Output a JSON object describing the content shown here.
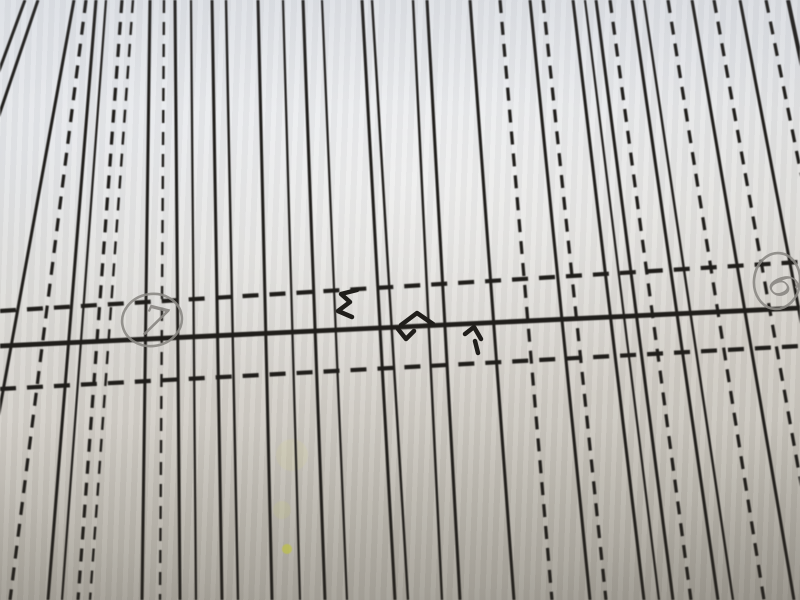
{
  "pattern": {
    "ink_color": "#201e1b",
    "pencil_color": "#8b8884",
    "vertical_dash": "13 9",
    "horizontal_dash": "16 11",
    "vertical_lines": [
      [
        25,
        -195,
        "s",
        3.0
      ],
      [
        38,
        -165,
        "s",
        3.0
      ],
      [
        74,
        -35,
        "s",
        3.0
      ],
      [
        86,
        10,
        "d",
        3.2
      ],
      [
        96,
        48,
        "s",
        3.0
      ],
      [
        106,
        62,
        "s",
        2.2
      ],
      [
        122,
        78,
        "d",
        3.2
      ],
      [
        133,
        90,
        "d",
        2.4
      ],
      [
        150,
        142,
        "s",
        3.0
      ],
      [
        164,
        160,
        "d",
        2.4
      ],
      [
        175,
        180,
        "s",
        3.0
      ],
      [
        191,
        196,
        "s",
        2.2
      ],
      [
        212,
        222,
        "s",
        3.0
      ],
      [
        226,
        238,
        "s",
        2.4
      ],
      [
        258,
        272,
        "s",
        3.0
      ],
      [
        283,
        300,
        "s",
        2.2
      ],
      [
        303,
        325,
        "s",
        3.0
      ],
      [
        322,
        347,
        "s",
        2.2
      ],
      [
        362,
        395,
        "s",
        3.0
      ],
      [
        372,
        408,
        "s",
        2.4
      ],
      [
        413,
        442,
        "s",
        2.4
      ],
      [
        427,
        460,
        "s",
        3.0
      ],
      [
        470,
        514,
        "s",
        3.0
      ],
      [
        500,
        552,
        "d",
        3.2
      ],
      [
        530,
        590,
        "s",
        3.0
      ],
      [
        543,
        606,
        "d",
        3.2
      ],
      [
        573,
        644,
        "s",
        3.0
      ],
      [
        585,
        659,
        "s",
        2.2
      ],
      [
        596,
        673,
        "s",
        3.0
      ],
      [
        610,
        691,
        "d",
        3.2
      ],
      [
        632,
        718,
        "s",
        3.0
      ],
      [
        644,
        733,
        "s",
        2.4
      ],
      [
        668,
        764,
        "d",
        3.2
      ],
      [
        692,
        794,
        "s",
        3.0
      ],
      [
        714,
        822,
        "d",
        3.2
      ],
      [
        740,
        854,
        "s",
        3.0
      ],
      [
        766,
        887,
        "d",
        3.2
      ],
      [
        788,
        915,
        "s",
        4.0
      ]
    ],
    "horizontal_lines": [
      [
        0,
        311,
        800,
        262,
        "d",
        4.2
      ],
      [
        0,
        346,
        800,
        308,
        "s",
        4.8
      ],
      [
        0,
        389,
        800,
        346,
        "d",
        4.2
      ]
    ],
    "notch_marks": [
      "357,290 341,294 350,302 338,311 352,317",
      "401,325 417,313 433,324",
      "398,329 406,339 414,331",
      "465,334 474,327 481,339",
      "475,341 478,353"
    ],
    "annotations": [
      {
        "label": "7",
        "cx": 152,
        "cy": 320,
        "rx": 30,
        "ry": 26,
        "circle_rotate": -10,
        "text_size": 42,
        "text_rotate": 14,
        "tx": 150,
        "ty": 336
      },
      {
        "label": "6",
        "cx": 777,
        "cy": 281,
        "rx": 23,
        "ry": 28,
        "circle_rotate": 6,
        "text_size": 36,
        "text_rotate": 55,
        "tx": 773,
        "ty": 293
      }
    ],
    "stains": [
      {
        "cx": 287,
        "cy": 549,
        "r": 5,
        "color": "#cdd04e",
        "opacity": 0.75
      },
      {
        "cx": 292,
        "cy": 455,
        "r": 16,
        "color": "#d6d298",
        "opacity": 0.22
      },
      {
        "cx": 282,
        "cy": 510,
        "r": 9,
        "color": "#d2d07c",
        "opacity": 0.18
      },
      {
        "cx": 872,
        "cy": 548,
        "r": 4,
        "color": "#cdd04e",
        "opacity": 0.5
      }
    ]
  }
}
